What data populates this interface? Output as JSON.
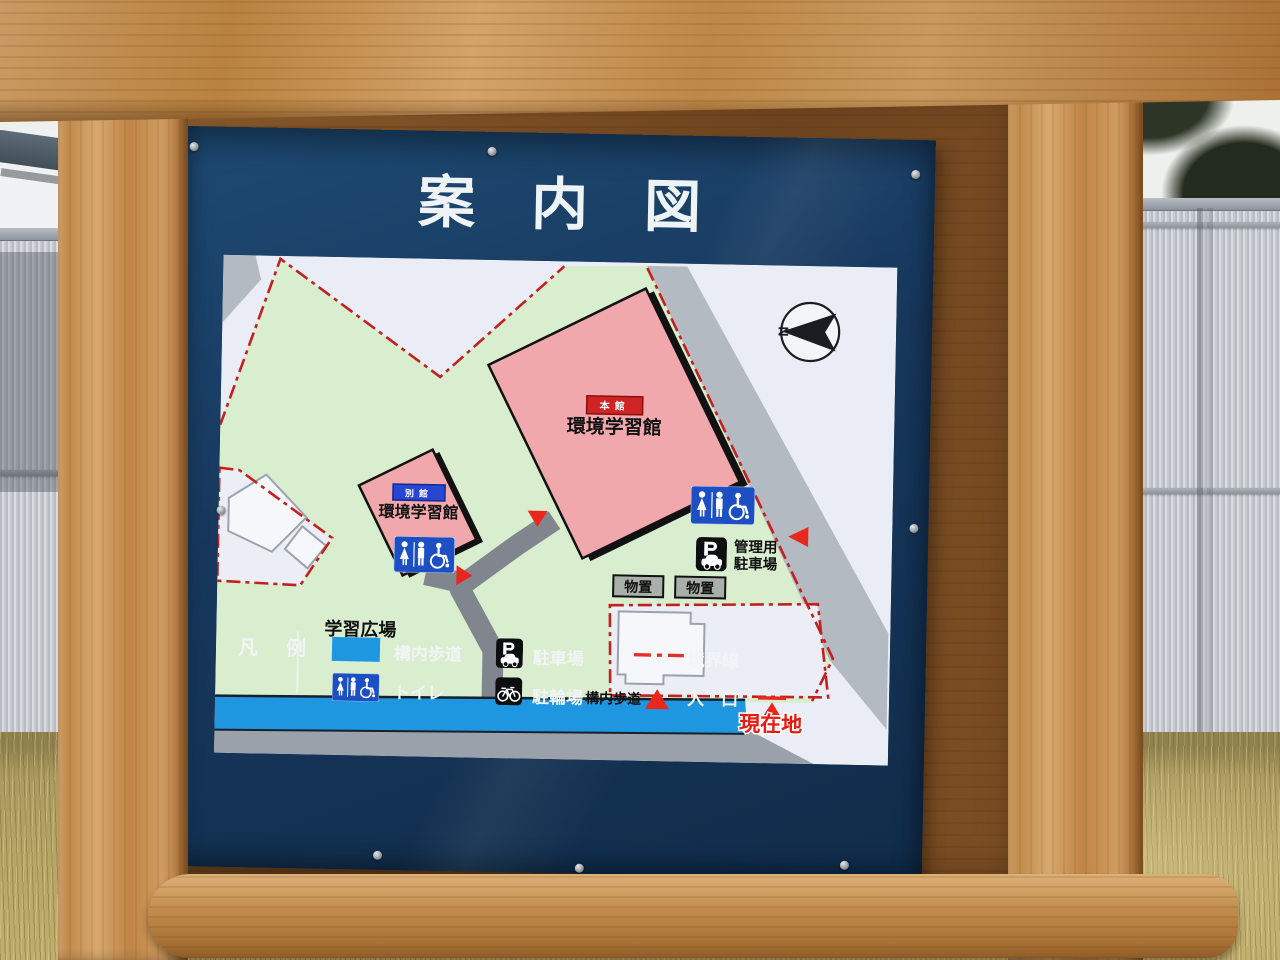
{
  "sign": {
    "title": "案内図",
    "map": {
      "north_label": "N",
      "main_building": {
        "badge": "本館",
        "name": "環境学習館"
      },
      "annex_building": {
        "badge": "別館",
        "name": "環境学習館"
      },
      "admin_parking": {
        "line1": "管理用",
        "line2": "駐車場"
      },
      "storage_left": "物置",
      "storage_right": "物置",
      "plaza": "学習広場",
      "walkway": "構内歩道",
      "you_are_here": "現在地"
    },
    "legend": {
      "heading": "凡　例",
      "walkway": "構内歩道",
      "toilet": "トイレ",
      "parking": "駐車場",
      "bicycle": "駐輪場",
      "boundary": "境界線",
      "entrance": "入　口"
    },
    "colors": {
      "panel_navy": "#17375c",
      "site_green": "#d9edcf",
      "building_pink": "#f0a8ac",
      "walkway_blue": "#1f97e0",
      "boundary_red": "#c32020",
      "marker_red": "#e8281c",
      "toilet_blue": "#1d4fc4",
      "road_gray": "#b4bac2"
    }
  }
}
